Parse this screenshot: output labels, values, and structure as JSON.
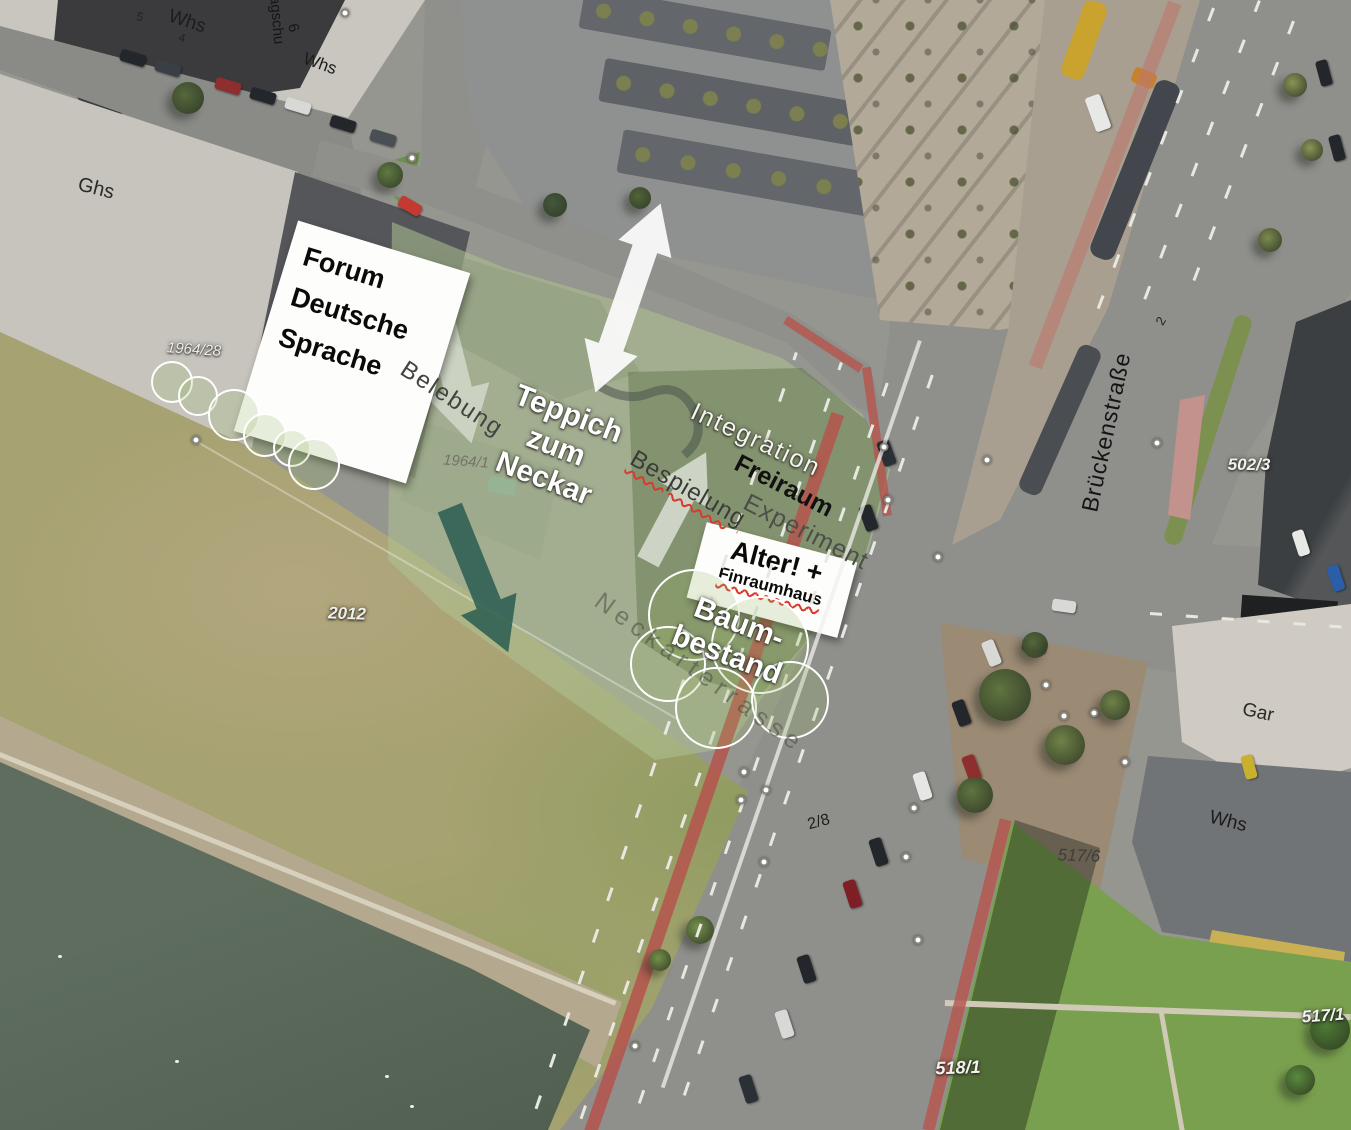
{
  "plan": {
    "boxes": {
      "forum": {
        "line1": "Forum",
        "line2": "Deutsche",
        "line3": "Sprache"
      },
      "alter": {
        "line1": "Alter! +",
        "line2": "Finraumhaus"
      }
    },
    "labels": [
      {
        "id": "whs-nw1",
        "text": "Whs",
        "x": 187,
        "y": 22,
        "rot": 18,
        "fs": 19,
        "color": "#1c1c1c"
      },
      {
        "id": "house-5",
        "text": "5",
        "x": 140,
        "y": 17,
        "rot": 15,
        "fs": 12,
        "color": "#222222"
      },
      {
        "id": "house-4",
        "text": "4",
        "x": 182,
        "y": 38,
        "rot": 15,
        "fs": 12,
        "color": "#222222"
      },
      {
        "id": "lagschu",
        "text": "Lagschu",
        "x": 276,
        "y": 16,
        "rot": 85,
        "fs": 15,
        "color": "#161616"
      },
      {
        "id": "house-6",
        "text": "6",
        "x": 293,
        "y": 28,
        "rot": 75,
        "fs": 15,
        "color": "#161616"
      },
      {
        "id": "whs-nw2",
        "text": "Whs",
        "x": 320,
        "y": 64,
        "rot": 20,
        "fs": 17,
        "color": "#1c1c1c"
      },
      {
        "id": "ghs",
        "text": "Ghs",
        "x": 96,
        "y": 189,
        "rot": 14,
        "fs": 20,
        "color": "#2a2a28"
      },
      {
        "id": "belebung",
        "text": "Belebung",
        "x": 452,
        "y": 399,
        "rot": 33,
        "fs": 24,
        "color": "#41453f",
        "ls": 2
      },
      {
        "id": "teppich",
        "lines": [
          "Teppich",
          "zum",
          "Neckar"
        ],
        "x": 556,
        "y": 447,
        "rot": 21,
        "fs": 30,
        "color": "#ffffff",
        "fw": 700,
        "halo": "dark",
        "lh": 1.15,
        "align": "center"
      },
      {
        "id": "integration",
        "text": "Integration",
        "x": 756,
        "y": 440,
        "rot": 25,
        "fs": 25,
        "color": "#f4f4f0",
        "ls": 2,
        "halo": "dark"
      },
      {
        "id": "freiraum",
        "text": "Freiraum",
        "x": 784,
        "y": 486,
        "rot": 27,
        "fs": 25,
        "fw": 700,
        "color": "#111111"
      },
      {
        "id": "experiment",
        "text": "Experiment",
        "x": 806,
        "y": 532,
        "rot": 27,
        "fs": 25,
        "color": "#4c4f49",
        "ls": 1
      },
      {
        "id": "bespielung",
        "text": "Bespielung",
        "x": 688,
        "y": 489,
        "rot": 30,
        "fs": 24,
        "color": "#3a3c38",
        "ls": 1,
        "wavy": true
      },
      {
        "id": "baum-bestand",
        "lines": [
          "Baum-",
          "bestand"
        ],
        "x": 733,
        "y": 639,
        "rot": 21,
        "fs": 30,
        "color": "#ffffff",
        "fw": 700,
        "halo": "dark",
        "lh": 1.12,
        "align": "center"
      },
      {
        "id": "neckarterrasse",
        "text": "Neckarterrasse",
        "x": 700,
        "y": 673,
        "rot": 36,
        "fs": 25,
        "color": "rgba(72,74,66,0.55)",
        "ls": 6
      },
      {
        "id": "brueckenstrasse",
        "text": "Brückenstraße",
        "x": 1106,
        "y": 432,
        "rot": -78,
        "fs": 23,
        "color": "#141414",
        "ls": 1
      },
      {
        "id": "house-2",
        "text": "2",
        "x": 1161,
        "y": 321,
        "rot": -60,
        "fs": 13,
        "color": "#222222"
      },
      {
        "id": "parcel-502-3",
        "text": "502/3",
        "x": 1249,
        "y": 465,
        "rot": 0,
        "fs": 17,
        "color": "#f2f2ec",
        "fst": "italic",
        "fw": 700,
        "halo": "dark"
      },
      {
        "id": "gar",
        "text": "Gar",
        "x": 1258,
        "y": 713,
        "rot": 12,
        "fs": 19,
        "color": "#2a2a28"
      },
      {
        "id": "whs-e",
        "text": "Whs",
        "x": 1228,
        "y": 822,
        "rot": 14,
        "fs": 19,
        "color": "#1c1c1c"
      },
      {
        "id": "parcel-517-6",
        "text": "517/6",
        "x": 1079,
        "y": 856,
        "rot": 2,
        "fs": 17,
        "color": "#3e3e3a",
        "fst": "italic"
      },
      {
        "id": "parcel-517-1",
        "text": "517/1",
        "x": 1323,
        "y": 1016,
        "rot": -4,
        "fs": 17,
        "color": "#f2f2ec",
        "fst": "italic",
        "fw": 700,
        "halo": "dark"
      },
      {
        "id": "parcel-518-1",
        "text": "518/1",
        "x": 958,
        "y": 1068,
        "rot": -2,
        "fs": 18,
        "color": "#f2f2ec",
        "fst": "italic",
        "fw": 700,
        "halo": "dark"
      },
      {
        "id": "parcel-2-8",
        "text": "2/8",
        "x": 819,
        "y": 823,
        "rot": -15,
        "fs": 16,
        "color": "#1d1d1b"
      },
      {
        "id": "parcel-1964-28",
        "text": "1964/28",
        "x": 194,
        "y": 350,
        "rot": 4,
        "fs": 15,
        "color": "#efefe9",
        "fst": "italic",
        "halo": "dark"
      },
      {
        "id": "parcel-1964-1",
        "text": "1964/1",
        "x": 466,
        "y": 462,
        "rot": 4,
        "fs": 15,
        "color": "#73736c",
        "fst": "italic"
      },
      {
        "id": "parcel-2012",
        "text": "2012",
        "x": 347,
        "y": 614,
        "rot": 2,
        "fs": 17,
        "color": "#efefe9",
        "fst": "italic",
        "fw": 700,
        "halo": "dark"
      }
    ],
    "colors": {
      "site_overlay_light": "rgba(175,195,148,0.55)",
      "site_overlay_dark": "rgba(95,115,72,0.45)",
      "arrow_white": "#ffffff",
      "arrow_teal": "#2d5f53",
      "spellcheck_red": "#d83a2e",
      "bike_lane_red": "#b5544c",
      "tree_circle_stroke": "#ffffff"
    },
    "annotations": {
      "tree_circles": [
        {
          "x": 172,
          "y": 382,
          "r": 21
        },
        {
          "x": 198,
          "y": 396,
          "r": 20
        },
        {
          "x": 234,
          "y": 415,
          "r": 26
        },
        {
          "x": 265,
          "y": 435,
          "r": 22
        },
        {
          "x": 292,
          "y": 448,
          "r": 19
        },
        {
          "x": 314,
          "y": 464,
          "r": 26
        },
        {
          "x": 694,
          "y": 615,
          "r": 46
        },
        {
          "x": 668,
          "y": 664,
          "r": 38
        },
        {
          "x": 760,
          "y": 645,
          "r": 49
        },
        {
          "x": 716,
          "y": 708,
          "r": 41
        },
        {
          "x": 790,
          "y": 700,
          "r": 39
        }
      ],
      "survey_points": [
        {
          "x": 345,
          "y": 13
        },
        {
          "x": 412,
          "y": 158
        },
        {
          "x": 196,
          "y": 440
        },
        {
          "x": 884,
          "y": 447
        },
        {
          "x": 888,
          "y": 500
        },
        {
          "x": 938,
          "y": 557
        },
        {
          "x": 987,
          "y": 460
        },
        {
          "x": 1157,
          "y": 443
        },
        {
          "x": 744,
          "y": 772
        },
        {
          "x": 766,
          "y": 790
        },
        {
          "x": 741,
          "y": 800
        },
        {
          "x": 764,
          "y": 862
        },
        {
          "x": 906,
          "y": 857
        },
        {
          "x": 914,
          "y": 808
        },
        {
          "x": 1046,
          "y": 685
        },
        {
          "x": 1064,
          "y": 716
        },
        {
          "x": 1094,
          "y": 713
        },
        {
          "x": 918,
          "y": 940
        },
        {
          "x": 1125,
          "y": 762
        },
        {
          "x": 635,
          "y": 1046
        }
      ]
    }
  }
}
